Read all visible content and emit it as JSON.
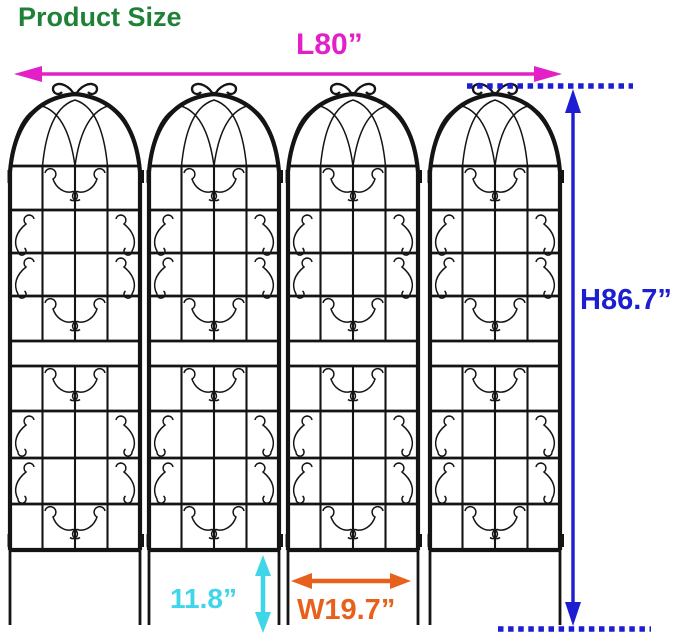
{
  "title": {
    "text": "Product Size",
    "color": "#1f8038"
  },
  "product": {
    "name": "metal-garden-trellis",
    "panel_count": 4,
    "frame_color": "#141414"
  },
  "dimensions": {
    "length": {
      "label": "L80”",
      "color": "#e320c8",
      "measures": "total length of 4 panels"
    },
    "height": {
      "label": "H86.7”",
      "color": "#1d1dd1",
      "measures": "total height"
    },
    "leg_height": {
      "label": "11.8”",
      "color": "#3fd6e9",
      "measures": "ground stake height"
    },
    "width": {
      "label": "W19.7”",
      "color": "#e8611c",
      "measures": "single panel width"
    }
  },
  "annotations": {
    "length_arrow": "double-headed-horizontal-arrow",
    "height_arrow": "double-headed-vertical-arrow",
    "height_extent_lines": "dotted-horizontal-extent-lines",
    "leg_height_arrow": "double-headed-vertical-arrow",
    "width_arrow": "double-headed-horizontal-arrow"
  }
}
